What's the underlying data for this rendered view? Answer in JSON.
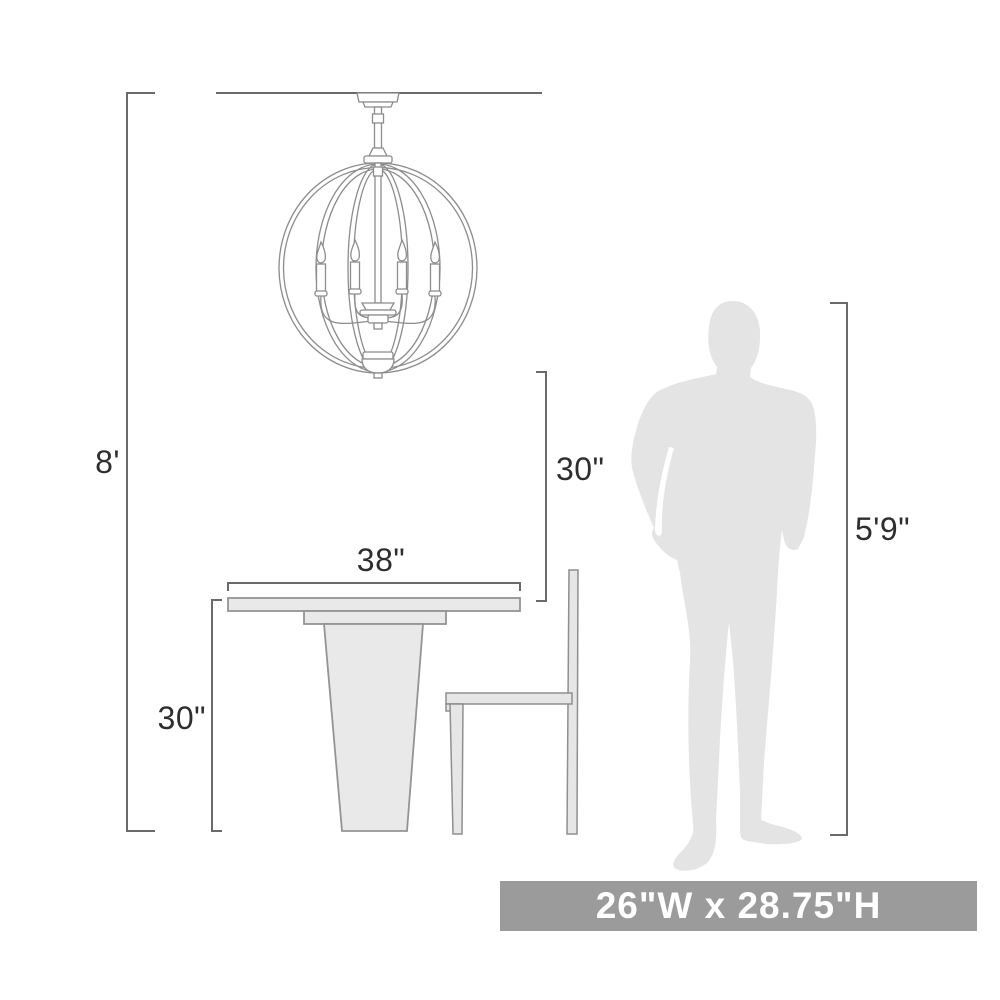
{
  "diagram": {
    "type": "product-dimensions",
    "subject": "6-light globe cage chandelier shown to scale above a pedestal dining table, side chair and standing person",
    "dimensions": {
      "ceiling_height": "8'",
      "fixture_to_table_clearance": "30\"",
      "table_width": "38\"",
      "table_height": "30\"",
      "person_height": "5'9\""
    },
    "banner": {
      "text": "26\"W x 28.75\"H"
    },
    "colors": {
      "background": "#ffffff",
      "dimension_line": "#6a6a6a",
      "label_text": "#2e2e2e",
      "artwork_line": "#8c8c8c",
      "object_fill": "#e9e9e9",
      "object_stroke": "#949494",
      "silhouette_fill": "#e4e4e4",
      "banner_bg": "#9b9b9b",
      "banner_text": "#ffffff"
    }
  }
}
